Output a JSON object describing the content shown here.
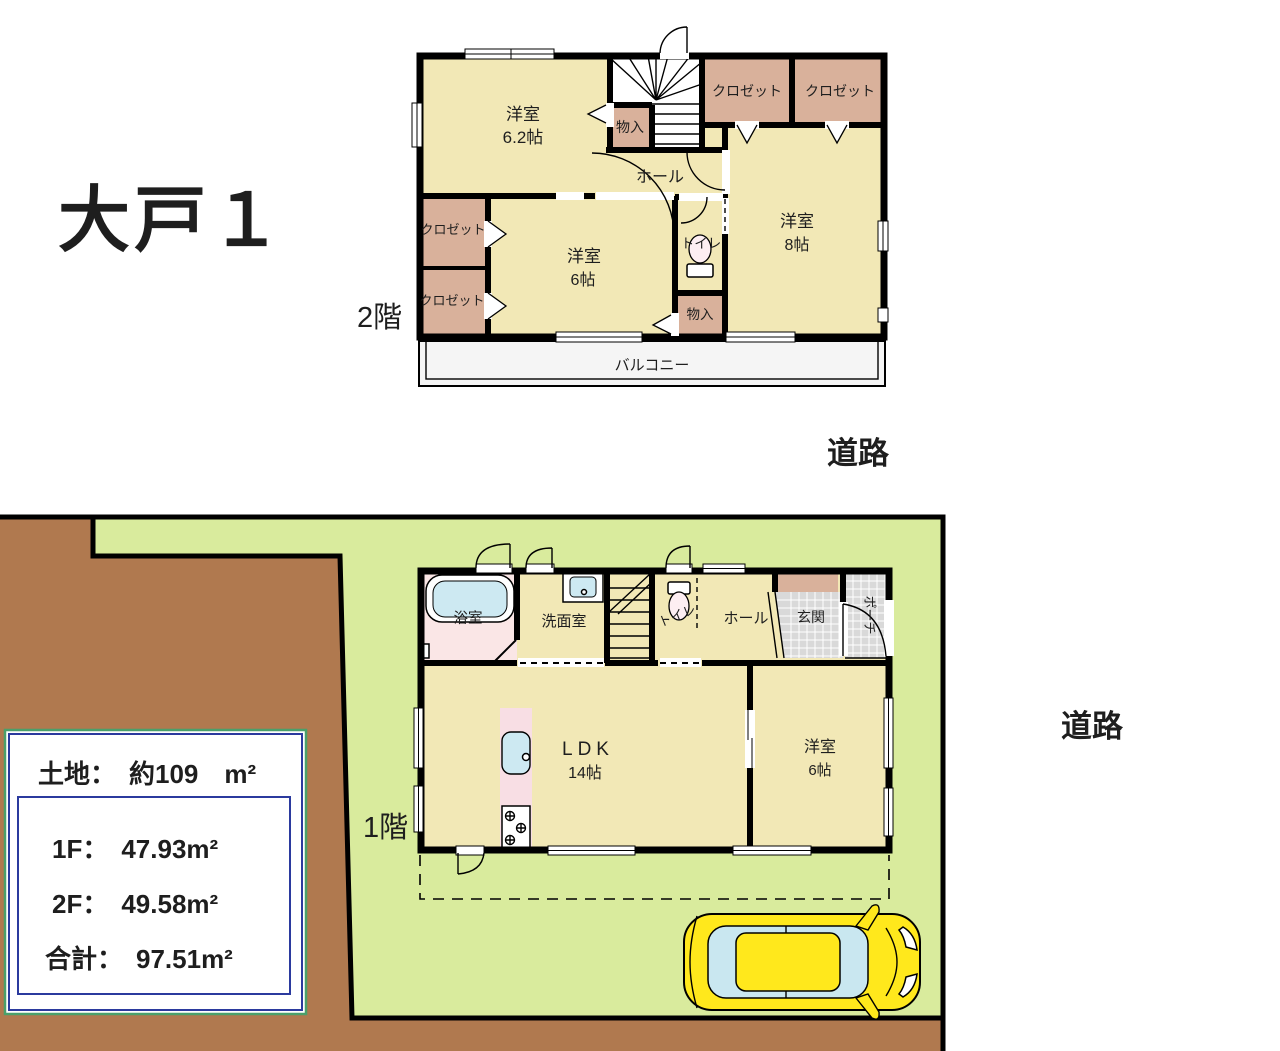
{
  "title": "大戸１",
  "roads": {
    "top": "道路",
    "right": "道路"
  },
  "floor2": {
    "label": "2階",
    "room62_name": "洋室",
    "room62_size": "6.2帖",
    "closet": "クロゼット",
    "storage": "物入",
    "hall": "ホール",
    "toilet": "トイレ",
    "room8_name": "洋室",
    "room8_size": "8帖",
    "room6_name": "洋室",
    "room6_size": "6帖",
    "balcony": "バルコニー"
  },
  "floor1": {
    "label": "1階",
    "bath": "浴室",
    "washroom": "洗面室",
    "toilet": "トイレ",
    "hall": "ホール",
    "entrance": "玄関",
    "porch": "ポーチ",
    "ldk_name": "LDK",
    "ldk_size": "14帖",
    "room6_name": "洋室",
    "room6_size": "6帖"
  },
  "info_box": {
    "land": "土地：　約109　m²",
    "floor1_area": "1F：　47.93m²",
    "floor2_area": "2F：　49.58m²",
    "total_area": "合計：　97.51m²"
  },
  "colors": {
    "room": "#f2e8b6",
    "closet": "#d9b19b",
    "bath_floor": "#fae6e6",
    "counter": "#f8dee4",
    "water": "#cde9f2",
    "toilet_bowl": "#fdeef2",
    "balcony": "#f5f5f5",
    "lot_green": "#d9eb9d",
    "land_brown": "#b0794f",
    "tile_grey": "#d9d9d9",
    "car_body": "#ffe81c",
    "car_glass": "#c9e7f0",
    "info_border": "#2b3a9e",
    "info_outline": "#4aa06b"
  }
}
